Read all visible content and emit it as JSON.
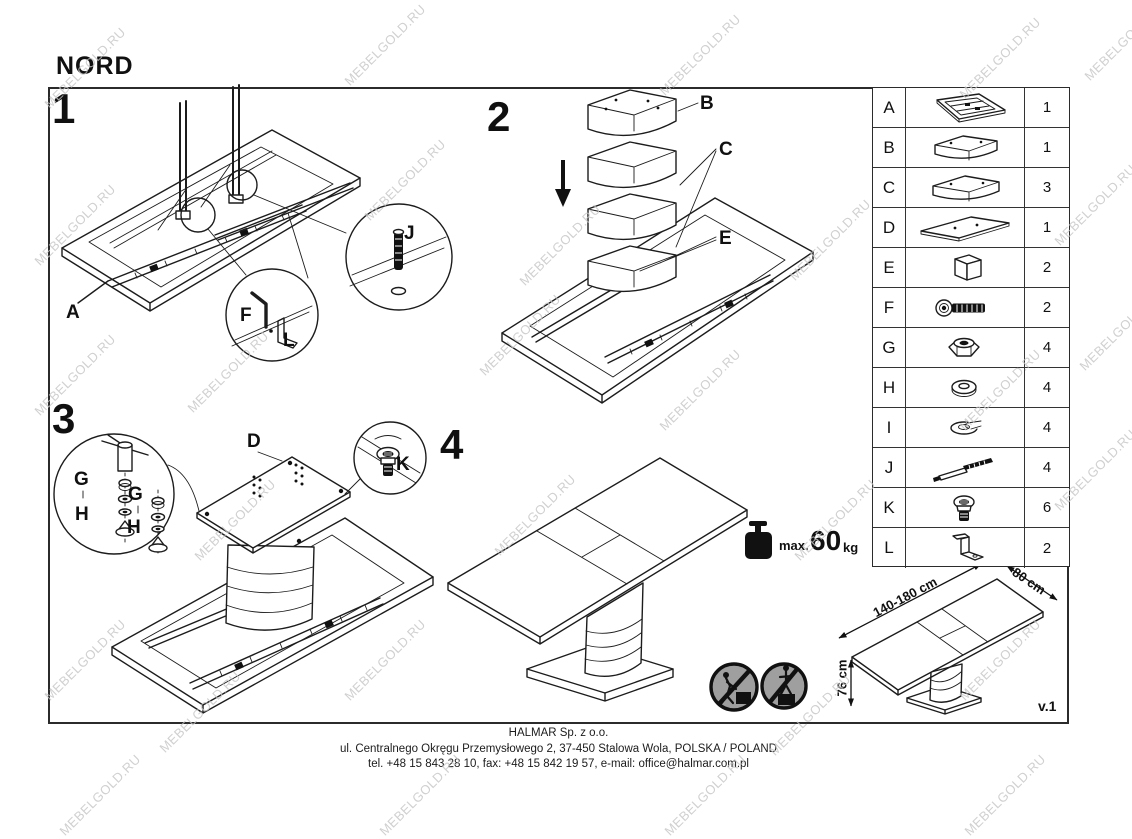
{
  "title": "NORD",
  "watermark": {
    "text": "MEBELGOLD.RU",
    "color": "#c5c5c5"
  },
  "steps": [
    {
      "number": "1",
      "labels": {
        "a": "A",
        "f": "F",
        "l": "L",
        "j": "J"
      }
    },
    {
      "number": "2",
      "labels": {
        "b": "B",
        "c": "C",
        "e": "E"
      }
    },
    {
      "number": "3",
      "labels": {
        "d": "D",
        "g": "G",
        "h": "H",
        "k": "K"
      }
    },
    {
      "number": "4",
      "weight": {
        "prefix": "max.",
        "value": "60",
        "unit": "kg"
      }
    }
  ],
  "dimensions": {
    "length": "140-180 cm",
    "width": "80 cm",
    "height": "76 cm"
  },
  "version": "v.1",
  "parts": {
    "rows": [
      {
        "letter": "A",
        "icon": "tabletop-frame-icon",
        "qty": "1"
      },
      {
        "letter": "B",
        "icon": "pedestal-segment-icon",
        "qty": "1"
      },
      {
        "letter": "C",
        "icon": "pedestal-segment-icon",
        "qty": "3"
      },
      {
        "letter": "D",
        "icon": "base-plate-icon",
        "qty": "1"
      },
      {
        "letter": "E",
        "icon": "spacer-block-icon",
        "qty": "2"
      },
      {
        "letter": "F",
        "icon": "socket-bolt-icon",
        "qty": "2"
      },
      {
        "letter": "G",
        "icon": "lock-nut-icon",
        "qty": "4"
      },
      {
        "letter": "H",
        "icon": "flat-washer-icon",
        "qty": "4"
      },
      {
        "letter": "I",
        "icon": "spring-washer-icon",
        "qty": "4"
      },
      {
        "letter": "J",
        "icon": "threaded-rod-icon",
        "qty": "4"
      },
      {
        "letter": "K",
        "icon": "dome-screw-icon",
        "qty": "6"
      },
      {
        "letter": "L",
        "icon": "l-bracket-icon",
        "qty": "2"
      }
    ]
  },
  "footer": {
    "company": "HALMAR Sp. z o.o.",
    "address": "ul. Centralnego Okręgu Przemysłowego 2, 37-450 Stalowa Wola, POLSKA / POLAND",
    "contact": "tel. +48 15 843 28 10, fax: +48 15 842 19 57, e-mail: office@halmar.com.pl"
  }
}
